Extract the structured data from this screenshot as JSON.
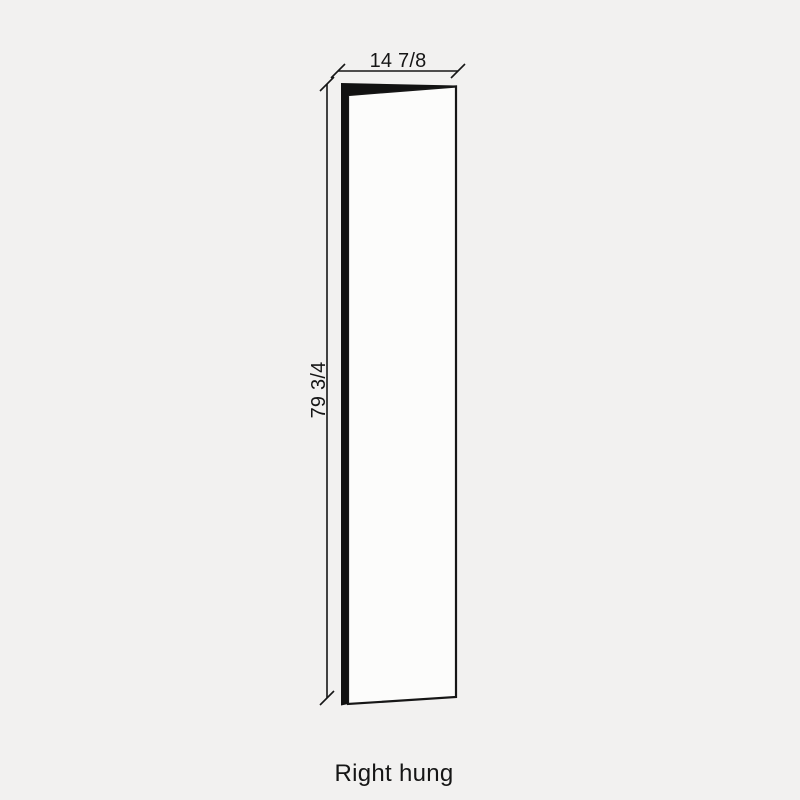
{
  "diagram": {
    "caption": "Right hung",
    "dimensions": {
      "width_label": "14 7/8",
      "height_label": "79 3/4"
    },
    "colors": {
      "background": "#f2f1f0",
      "line": "#161616",
      "door_edge": "#111111",
      "door_face": "#fcfcfb"
    }
  }
}
